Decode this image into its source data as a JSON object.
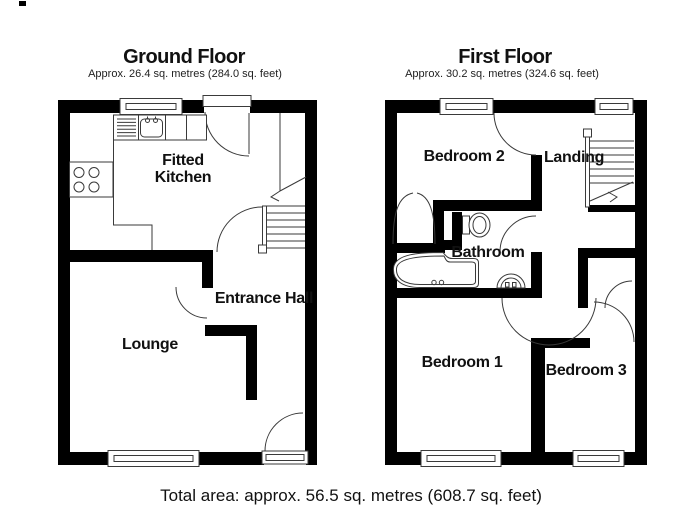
{
  "ground_floor": {
    "title": "Ground Floor",
    "area": "Approx. 26.4 sq. metres (284.0 sq. feet)",
    "rooms": {
      "kitchen": "Fitted Kitchen",
      "entrance_hall": "Entrance Hall",
      "lounge": "Lounge"
    }
  },
  "first_floor": {
    "title": "First Floor",
    "area": "Approx. 30.2 sq. metres (324.6 sq. feet)",
    "rooms": {
      "bedroom2": "Bedroom 2",
      "landing": "Landing",
      "bathroom": "Bathroom",
      "bedroom1": "Bedroom 1",
      "bedroom3": "Bedroom 3"
    }
  },
  "footer": {
    "total_area": "Total area: approx. 56.5 sq. metres (608.7 sq. feet)"
  },
  "colors": {
    "wall": "#000000",
    "thin_line": "#3a3a3a",
    "background": "#ffffff",
    "text": "#111111"
  }
}
